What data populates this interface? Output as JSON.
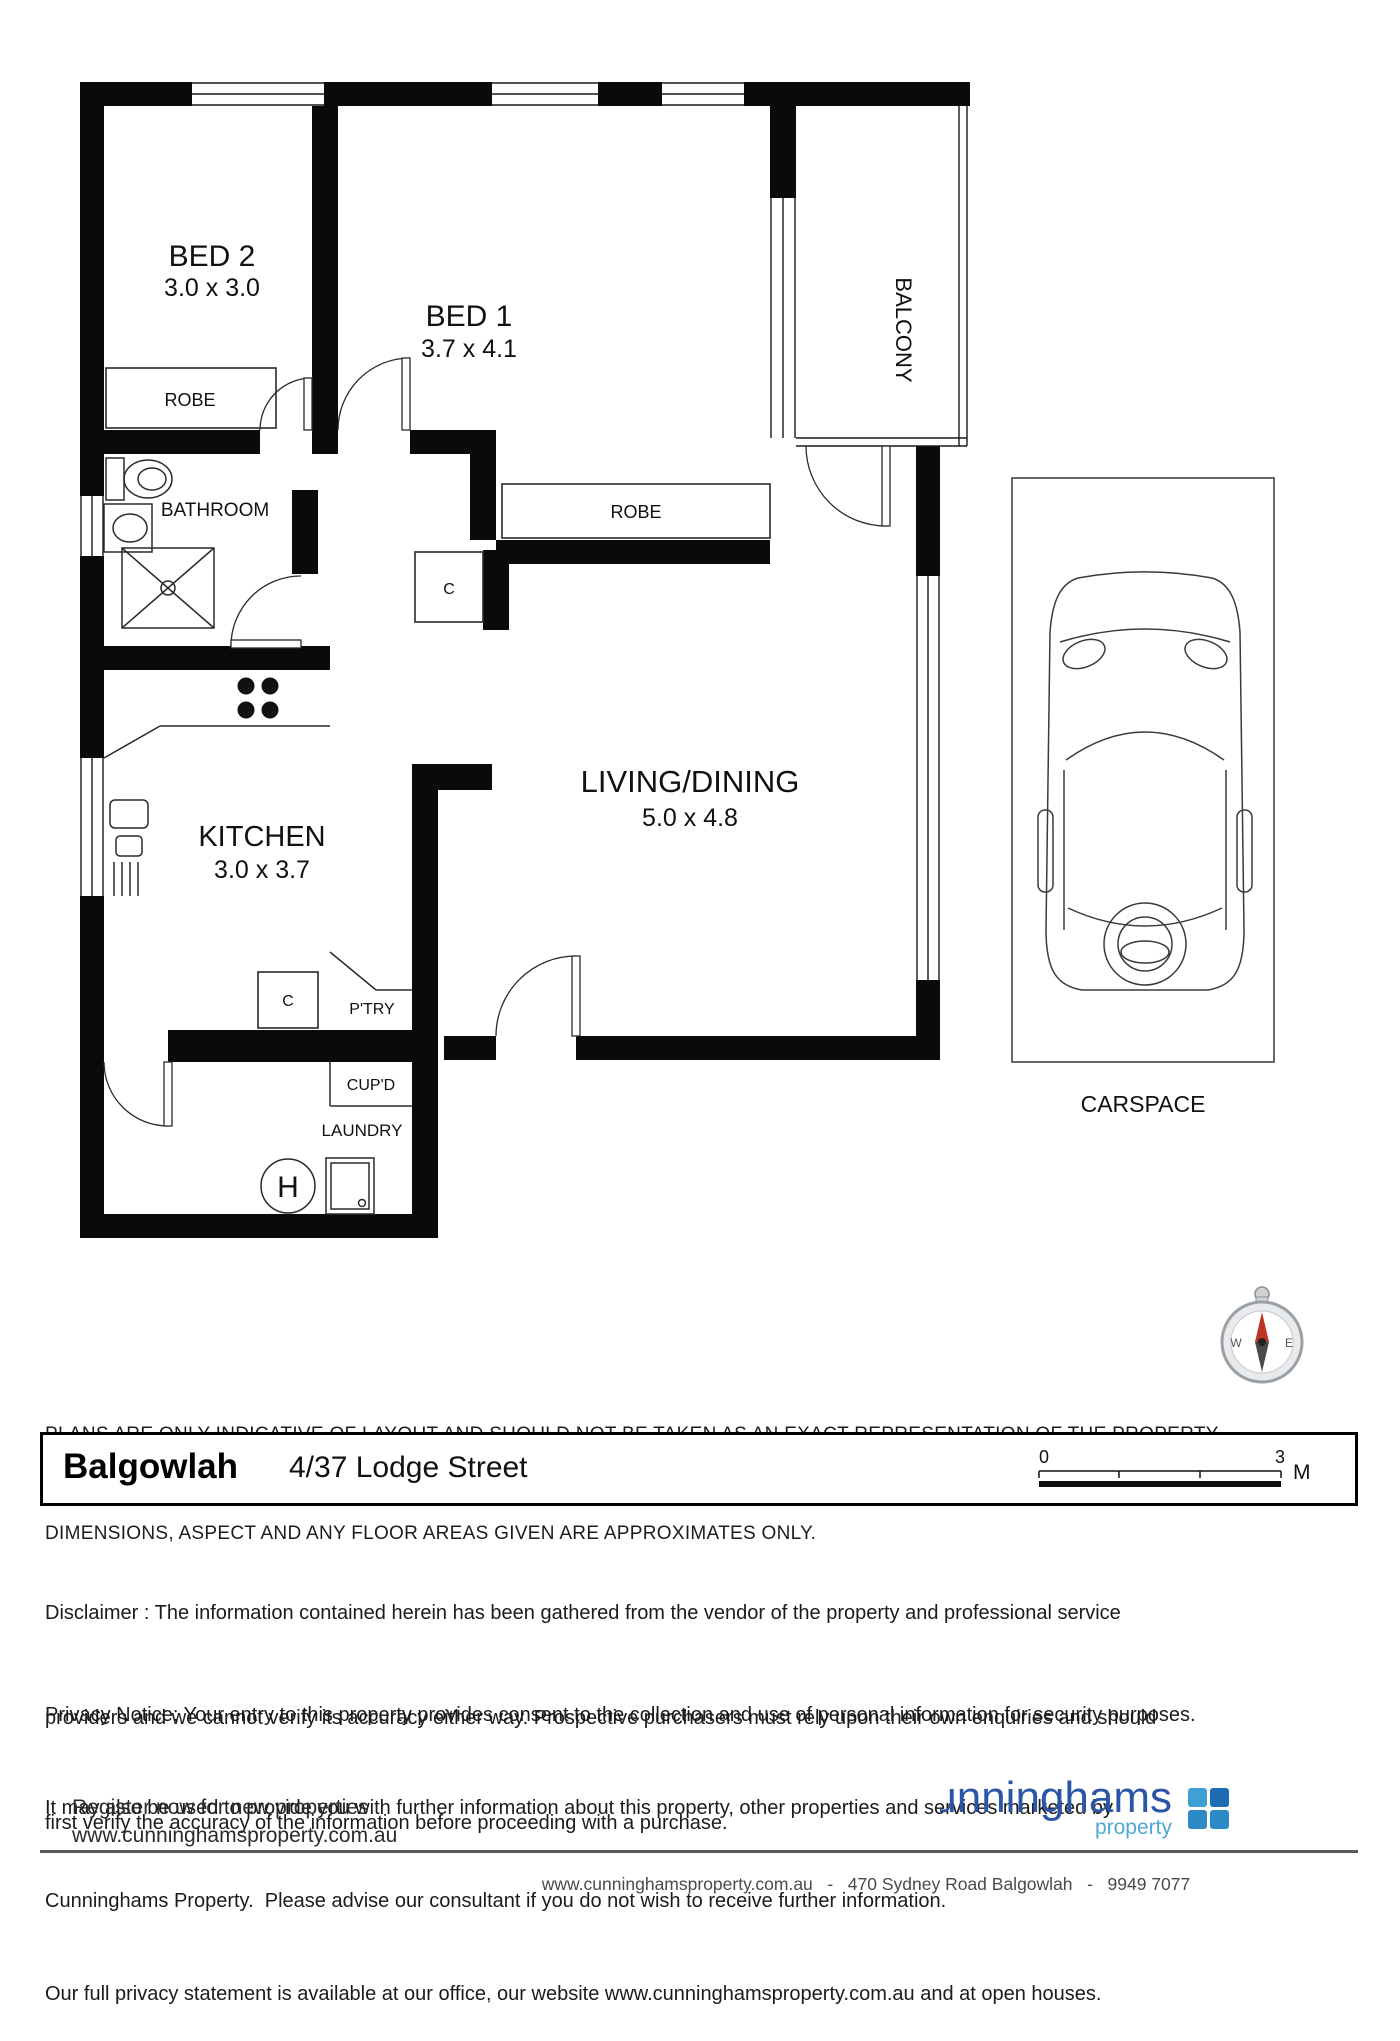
{
  "floorplan": {
    "rooms": {
      "bed2": {
        "label": "BED 2",
        "dims": "3.0 x 3.0"
      },
      "bed1": {
        "label": "BED 1",
        "dims": "3.7 x 4.1"
      },
      "kitchen": {
        "label": "KITCHEN",
        "dims": "3.0 x 3.7"
      },
      "living": {
        "label": "LIVING/DINING",
        "dims": "5.0 x 4.8"
      },
      "bathroom": {
        "label": "BATHROOM"
      },
      "balcony": {
        "label": "BALCONY"
      },
      "laundry": {
        "label": "LAUNDRY"
      },
      "carspace": {
        "label": "CARSPACE"
      }
    },
    "features": {
      "robe_bed2": "ROBE",
      "robe_bed1": "ROBE",
      "closet_hall": "C",
      "closet_kitchen": "C",
      "pantry": "P'TRY",
      "cupboard": "CUP'D",
      "hot_water_unit": "H"
    }
  },
  "notice": {
    "line1": "PLANS ARE ONLY INDICATIVE OF LAYOUT AND SHOULD NOT BE TAKEN AS AN EXACT REPRESENTATION OF THE PROPERTY.",
    "line2": "DIMENSIONS, ASPECT AND ANY FLOOR AREAS GIVEN ARE APPROXIMATES ONLY."
  },
  "address_bar": {
    "suburb": "Balgowlah",
    "street": "4/37 Lodge Street",
    "scale": {
      "start": "0",
      "end": "3",
      "unit": "M"
    }
  },
  "disclaimer": {
    "lines": [
      "Disclaimer : The information contained herein has been gathered from the vendor of the property and professional service",
      "providers and we cannot verify its accuracy either way. Prospective purchasers must rely upon their own enquiries and should",
      "first verify the accuracy of the information before proceeding with a purchase."
    ]
  },
  "privacy": {
    "lines": [
      "Privacy Notice: Your entry to this property provides consent to the collection and use of personal information for security purposes.",
      "It may also be used to provide you with further information about this property, other properties and services marketed by",
      "Cunninghams Property.  Please advise our consultant if you do not wish to receive further information.",
      "Our full privacy statement is available at our office, our website www.cunninghamsproperty.com.au and at open houses."
    ]
  },
  "register": {
    "line1": "Register now for new properties",
    "line2": "www.cunninghamsproperty.com.au"
  },
  "logo": {
    "name": "cunninghams",
    "tagline": "property",
    "colors": {
      "name": "#2a56a5",
      "tagline": "#4fa8d8",
      "sq_tl": "#3fa0d6",
      "sq_tr": "#1e6cb5",
      "sq_bl": "#2e8ac6",
      "sq_br": "#2e8ac6"
    }
  },
  "compass": {
    "west": "W",
    "east": "E"
  },
  "footer": {
    "contact": "www.cunninghamsproperty.com.au   -   470 Sydney Road Balgowlah   -   9949 7077"
  }
}
